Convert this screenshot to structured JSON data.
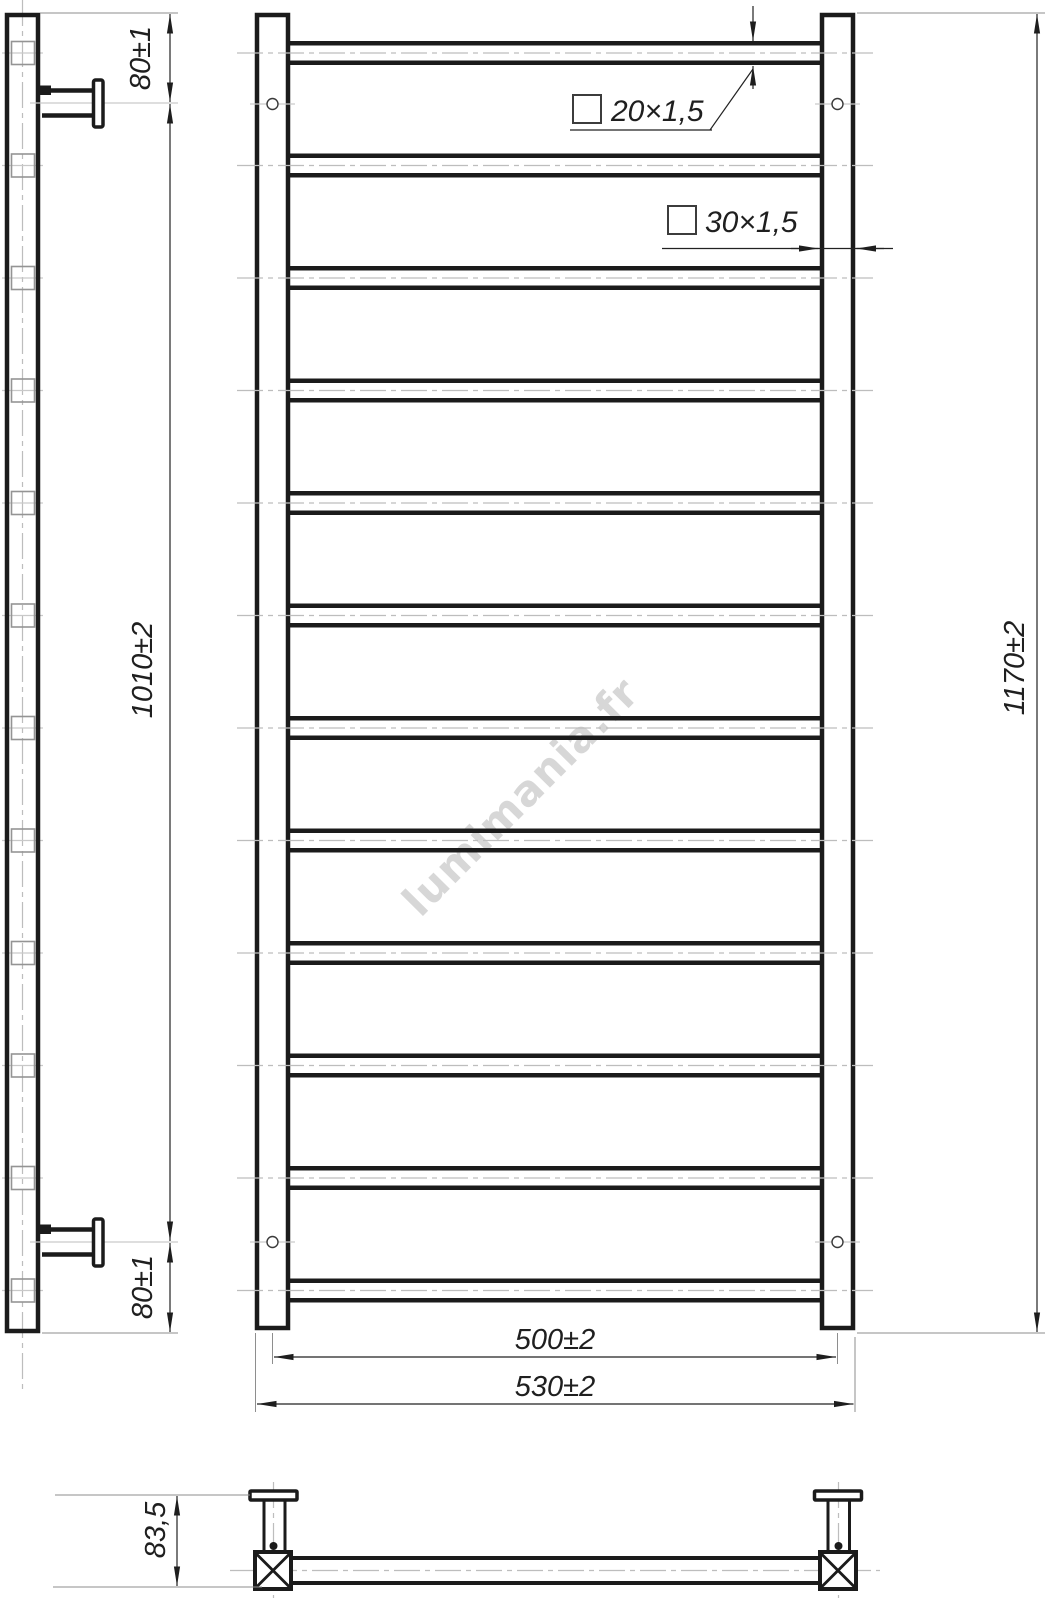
{
  "watermark": "lumimania.fr",
  "labels": {
    "rung_profile": "20×1,5",
    "post_profile": "30×1,5"
  },
  "dims": {
    "top_offset": "80±1",
    "bracket_spacing": "1010±2",
    "bottom_offset": "80±1",
    "overall_height": "1170±2",
    "centers_width": "500±2",
    "overall_width": "530±2",
    "bracket_depth": "83,5"
  }
}
